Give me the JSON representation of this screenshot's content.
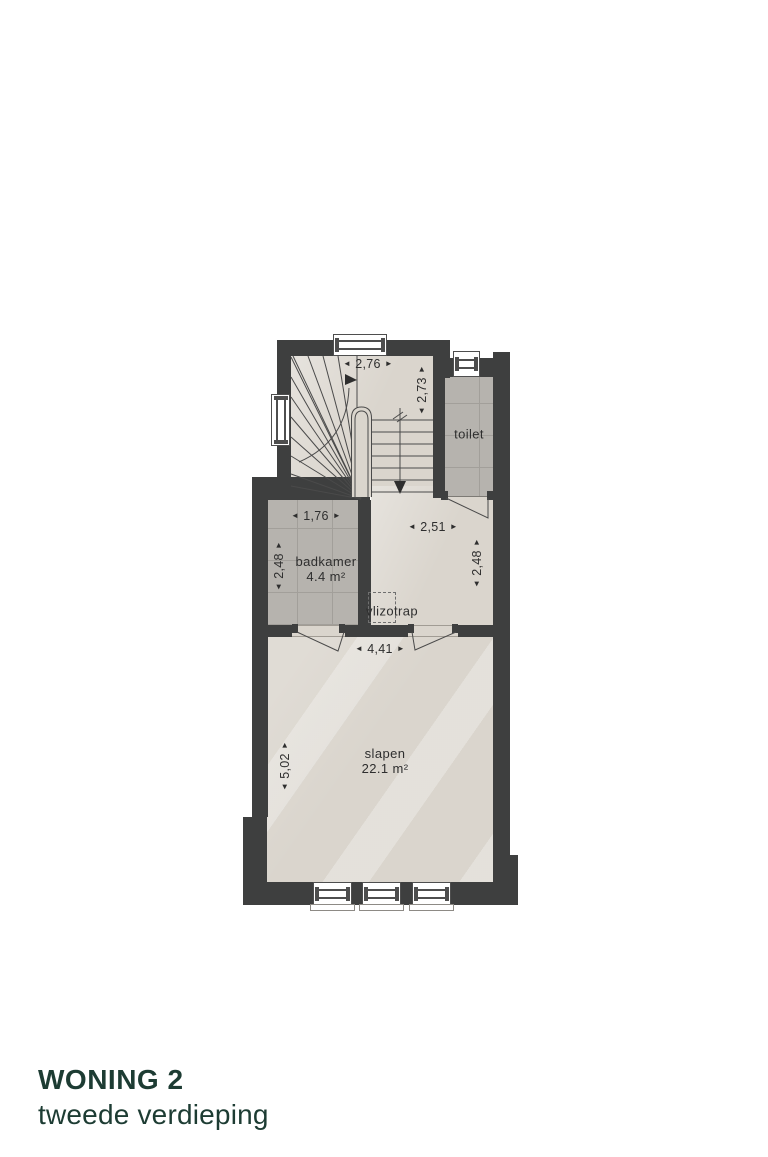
{
  "title": {
    "project": "WONING 2",
    "floor": "tweede verdieping"
  },
  "rooms": {
    "toilet": {
      "name": "toilet"
    },
    "badkamer": {
      "name": "badkamer",
      "area": "4.4 m²"
    },
    "slapen": {
      "name": "slapen",
      "area": "22.1 m²"
    },
    "vlizotrap": {
      "name": "vlizotrap"
    }
  },
  "dimensions": {
    "stairs_width": "2,76",
    "stairs_depth": "2,73",
    "badkamer_width": "1,76",
    "badkamer_depth": "2,48",
    "hall_width": "2,51",
    "hall_depth": "2,48",
    "slapen_width": "4,41",
    "slapen_depth": "5,02"
  },
  "glyphs": {
    "arrow_left": "◄",
    "arrow_right": "►"
  },
  "colors": {
    "wall": "#3e3f3f",
    "floor": "#dad5cd",
    "tile": "#b6b3ae",
    "accent": "#1d3c33",
    "text": "#2e2e2e"
  }
}
